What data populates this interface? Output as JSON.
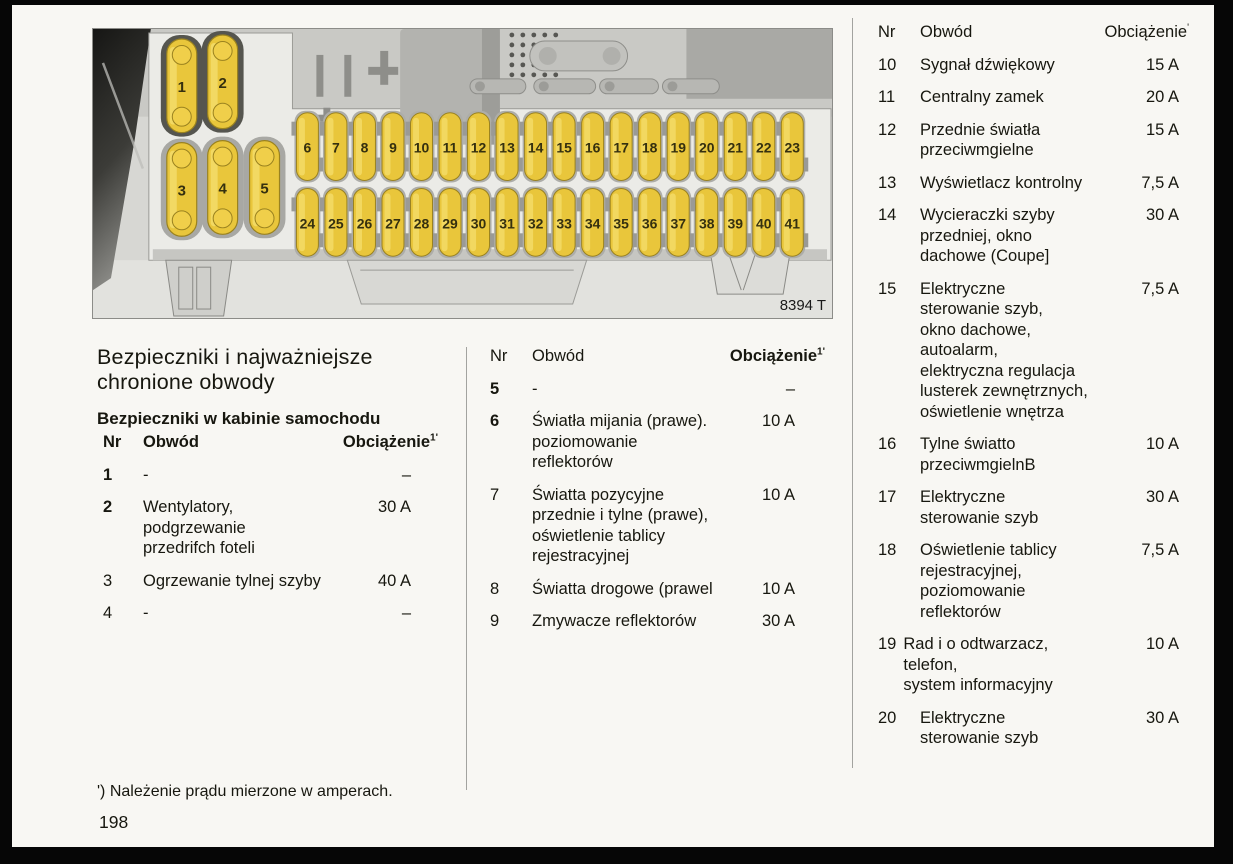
{
  "document": {
    "title_line1": "Bezpieczniki i najważniejsze",
    "title_line2": "chronione obwody",
    "subtitle": "Bezpieczniki w kabinie samochodu",
    "footnote": "') Należenie prądu mierzone w amperach.",
    "page_number": "198"
  },
  "table_headers": {
    "nr": "Nr",
    "circuit": "Obwód",
    "load": "Obciążenie",
    "load_sup": "1'",
    "load_sup_right": "'"
  },
  "fuse_tables": {
    "cabin_left": [
      {
        "nr": "1",
        "circuit": [
          "-"
        ],
        "load": "–"
      },
      {
        "nr": "2",
        "circuit": [
          "Wentylatory,",
          "podgrzewanie",
          "przedrifch foteli"
        ],
        "load": "30 A"
      },
      {
        "nr": "3",
        "circuit": [
          "Ogrzewanie tylnej szyby"
        ],
        "load": "40 A"
      },
      {
        "nr": "4",
        "circuit": [
          "-"
        ],
        "load": "–"
      }
    ],
    "cabin_middle": [
      {
        "nr": "5",
        "circuit": [
          "-"
        ],
        "load": "–"
      },
      {
        "nr": "6",
        "circuit": [
          "Światła mijania (prawe).",
          "poziomowanie",
          "reflektorów"
        ],
        "load": "10 A"
      },
      {
        "nr": "7",
        "circuit": [
          "Światta pozycyjne",
          "przednie i tylne (prawe),",
          "oświetlenie tablicy",
          "rejestracyjnej"
        ],
        "load": "10 A"
      },
      {
        "nr": "8",
        "circuit": [
          "Światta drogowe (prawel"
        ],
        "load": "10 A"
      },
      {
        "nr": "9",
        "circuit": [
          "Zmywacze reflektorów"
        ],
        "load": "30 A"
      }
    ],
    "cabin_right": [
      {
        "nr": "10",
        "circuit": [
          "Sygnał dźwiękowy"
        ],
        "load": "15 A"
      },
      {
        "nr": "11",
        "circuit": [
          "Centralny zamek"
        ],
        "load": "20 A"
      },
      {
        "nr": "12",
        "circuit": [
          "Przednie światła",
          "przeciwmgielne"
        ],
        "load": "15 A"
      },
      {
        "nr": "13",
        "circuit": [
          "Wyświetlacz kontrolny"
        ],
        "load": "7,5 A"
      },
      {
        "nr": "14",
        "circuit": [
          "Wycieraczki szyby",
          "przedniej, okno",
          "dachowe (Coupe]"
        ],
        "load": "30 A"
      },
      {
        "nr": "15",
        "circuit": [
          "Elektryczne",
          "sterowanie szyb,",
          "okno dachowe,",
          "autoalarm,",
          "elektryczna regulacja",
          "lusterek zewnętrznych,",
          "oświetlenie wnętrza"
        ],
        "load": "7,5 A"
      },
      {
        "nr": "16",
        "circuit": [
          "Tylne światto",
          "przeciwmgielnB"
        ],
        "load": "10 A"
      },
      {
        "nr": "17",
        "circuit": [
          "Elektryczne",
          "sterowanie szyb"
        ],
        "load": "30 A"
      },
      {
        "nr": "18",
        "circuit": [
          "Oświetlenie tablicy",
          "rejestracyjnej,",
          "poziomowanie",
          "reflektorów"
        ],
        "load": "7,5 A"
      },
      {
        "nr": "19",
        "tight": true,
        "circuit": [
          "Rad i o odtwarzacz,",
          "telefon,",
          "system informacyjny"
        ],
        "load": "10 A"
      },
      {
        "nr": "20",
        "circuit": [
          "Elektryczne",
          "sterowanie szyb"
        ],
        "load": "30 A"
      }
    ]
  },
  "figure": {
    "caption": "8394 T",
    "large_fuses": [
      "1",
      "2",
      "3",
      "4",
      "5"
    ],
    "small_fuses_top": [
      "6",
      "7",
      "8",
      "9",
      "10",
      "11",
      "12",
      "13",
      "14",
      "15",
      "16",
      "17",
      "18",
      "19",
      "20",
      "21",
      "22",
      "23"
    ],
    "small_fuses_bottom": [
      "24",
      "25",
      "26",
      "27",
      "28",
      "29",
      "30",
      "31",
      "32",
      "33",
      "34",
      "35",
      "36",
      "37",
      "38",
      "39",
      "40",
      "41"
    ],
    "colors": {
      "fuse_yellow": "#e9c63b",
      "fuse_highlight": "#f4dd6e",
      "fuse_stroke": "#9a821f",
      "fuse_number": "#35300f"
    }
  }
}
